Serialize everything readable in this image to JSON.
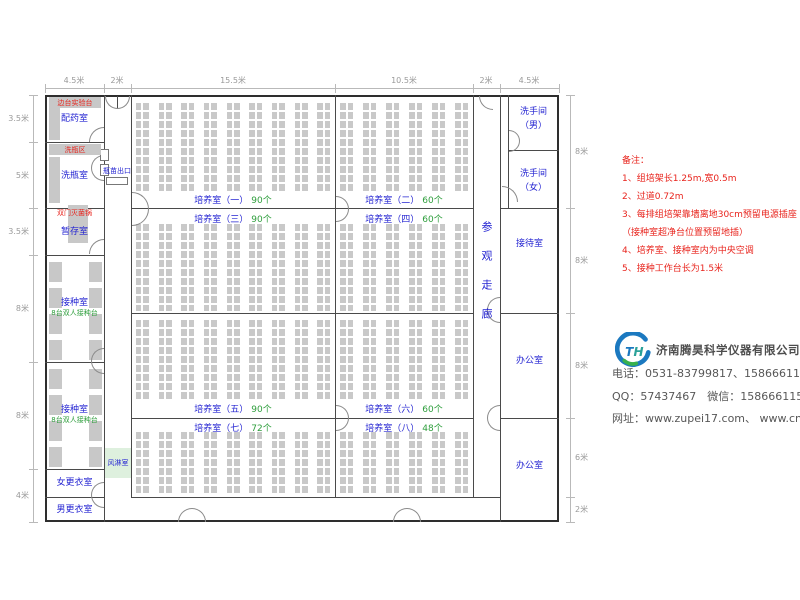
{
  "dims": {
    "top": [
      "4.5米",
      "2米",
      "15.5米",
      "10.5米",
      "2米",
      "4.5米"
    ],
    "left": [
      "3.5米",
      "5米",
      "3.5米",
      "8米",
      "8米",
      "4米"
    ],
    "right": [
      "8米",
      "8米",
      "8米",
      "6米",
      "2米"
    ]
  },
  "plan": {
    "left_rooms": [
      {
        "label": "配药室"
      },
      {
        "label": "洗瓶室"
      },
      {
        "label": "暂存室"
      },
      {
        "label": "接种室",
        "sub": "8台双人接种台"
      },
      {
        "label": "接种室",
        "sub": "8台双人接种台"
      },
      {
        "label": "女更衣室"
      },
      {
        "label": "男更衣室"
      }
    ],
    "red_labels": {
      "bench": "边台实验台",
      "wash_area": "洗瓶区",
      "sterilizer": "双门灭菌锅"
    },
    "corridor": {
      "bottle_exit": "瓶苗出口",
      "air_shower": "风淋室"
    },
    "culture_rooms": [
      {
        "label": "培养室（一）",
        "count": "90个"
      },
      {
        "label": "培养室（二）",
        "count": "60个"
      },
      {
        "label": "培养室（三）",
        "count": "90个"
      },
      {
        "label": "培养室（四）",
        "count": "60个"
      },
      {
        "label": "培养室（五）",
        "count": "90个"
      },
      {
        "label": "培养室（六）",
        "count": "60个"
      },
      {
        "label": "培养室（七）",
        "count": "72个"
      },
      {
        "label": "培养室（八）",
        "count": "48个"
      }
    ],
    "gallery": "参观走廊",
    "right_rooms": [
      {
        "label": "洗手间",
        "sub": "（男）"
      },
      {
        "label": "洗手间",
        "sub": "（女）"
      },
      {
        "label": "接待室"
      },
      {
        "label": "办公室"
      },
      {
        "label": "办公室"
      }
    ]
  },
  "notes": {
    "title": "备注：",
    "items": [
      "1、组培架长1.25m,宽0.5m",
      "2、过道0.72m",
      "3、每排组培架靠墙离地30cm预留电源插座",
      "（接种室超净台位置预留地插）",
      "4、培养室、接种室内为中央空调",
      "5、接种工作台长为1.5米"
    ]
  },
  "company": {
    "logo_t": "T",
    "logo_h": "H",
    "name": "济南腾昊科学仪器有限公司",
    "phone": "电话：0531-83799817、15866611552",
    "qq_wechat": "QQ：57437467　微信：15866611552",
    "website": "网址：www.zupei17.com、 www.cnhtkj.com"
  },
  "colors": {
    "room_label_blue": "#2525d2",
    "count_green": "#2e9e3c",
    "note_red": "#e8241d",
    "rack_gray": "#c9c9c9",
    "air_shower_bg": "#def0de",
    "logo_blue": "#1b79c0",
    "logo_green": "#37b04c"
  }
}
